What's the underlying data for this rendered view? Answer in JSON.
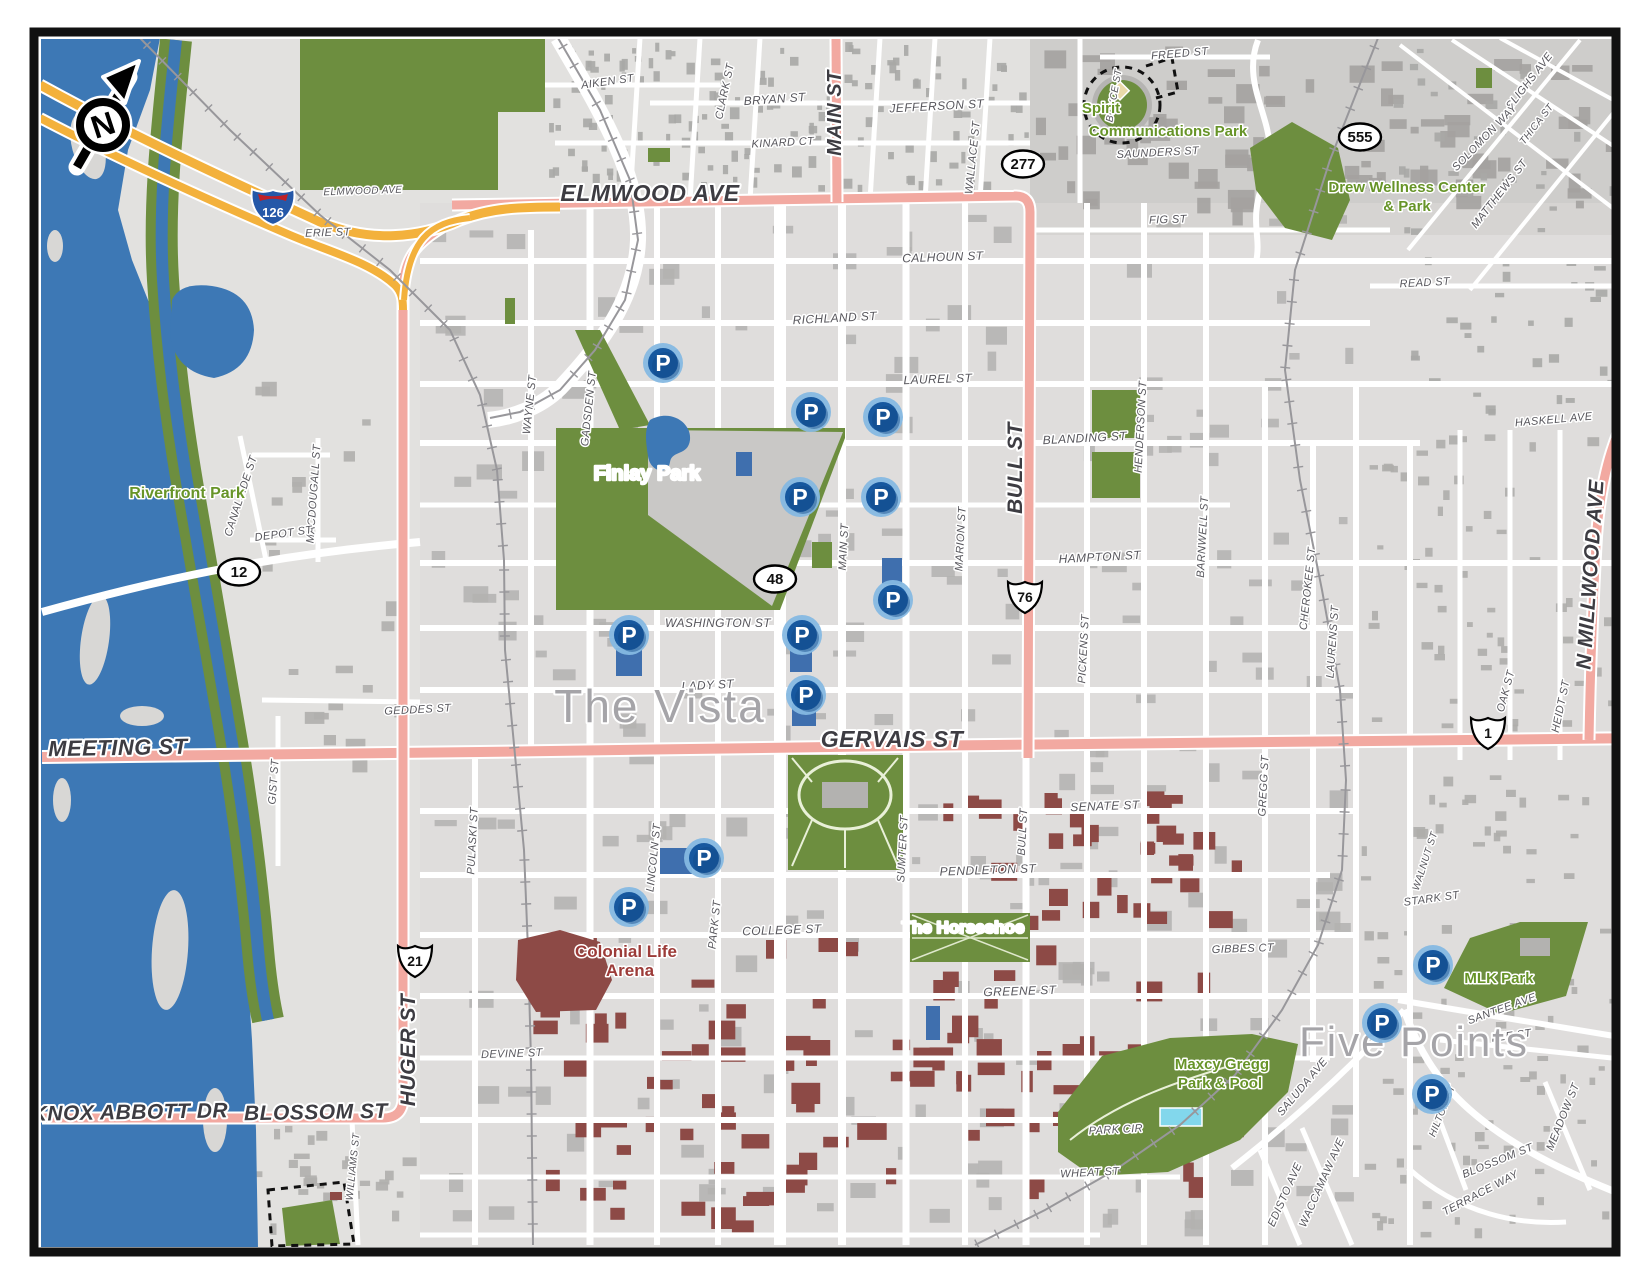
{
  "colors": {
    "land": "#e2e1df",
    "block_dark": "#cecdcb",
    "building": "#aeadab",
    "campus_building": "#8d4a46",
    "park_green": "#6d8e3f",
    "water_blue": "#3d78b5",
    "pool_cyan": "#82d7ec",
    "road_pink": "#f2a9a1",
    "freeway_yellow": "#f3b13c",
    "parking_blue": "#17589f",
    "parking_ring": "#85b8e2",
    "label_gray": "#57565c"
  },
  "compass": {
    "label": "N"
  },
  "shields": [
    {
      "type": "interstate",
      "text": "126",
      "x": 273,
      "y": 207
    },
    {
      "type": "oval",
      "text": "277",
      "x": 1023,
      "y": 164
    },
    {
      "type": "oval",
      "text": "555",
      "x": 1360,
      "y": 137
    },
    {
      "type": "oval",
      "text": "12",
      "x": 239,
      "y": 572
    },
    {
      "type": "oval",
      "text": "48",
      "x": 775,
      "y": 579
    },
    {
      "type": "us",
      "text": "76",
      "x": 1025,
      "y": 597
    },
    {
      "type": "us",
      "text": "1",
      "x": 1488,
      "y": 733
    },
    {
      "type": "us",
      "text": "21",
      "x": 415,
      "y": 961
    }
  ],
  "parking_markers": [
    {
      "x": 663,
      "y": 363
    },
    {
      "x": 811,
      "y": 412
    },
    {
      "x": 883,
      "y": 417
    },
    {
      "x": 800,
      "y": 497
    },
    {
      "x": 881,
      "y": 497
    },
    {
      "x": 893,
      "y": 600
    },
    {
      "x": 629,
      "y": 635
    },
    {
      "x": 802,
      "y": 635
    },
    {
      "x": 806,
      "y": 695
    },
    {
      "x": 704,
      "y": 858
    },
    {
      "x": 629,
      "y": 907
    },
    {
      "x": 1433,
      "y": 965
    },
    {
      "x": 1382,
      "y": 1023
    },
    {
      "x": 1432,
      "y": 1094
    }
  ],
  "labels": [
    {
      "t": "AIKEN ST",
      "x": 608,
      "y": 85,
      "r": -8,
      "c": "st",
      "s": 11
    },
    {
      "t": "CLARK ST",
      "x": 728,
      "y": 92,
      "r": -78,
      "c": "st",
      "s": 11
    },
    {
      "t": "BRYAN ST",
      "x": 775,
      "y": 103,
      "r": -4,
      "c": "st",
      "s": 12
    },
    {
      "t": "KINARD CT",
      "x": 783,
      "y": 146,
      "r": -3,
      "c": "st",
      "s": 11
    },
    {
      "t": "MAIN ST",
      "x": 841,
      "y": 113,
      "r": -90,
      "c": "maj",
      "s": 20
    },
    {
      "t": "JEFFERSON ST",
      "x": 937,
      "y": 110,
      "r": -3,
      "c": "st",
      "s": 12
    },
    {
      "t": "WALLACE ST",
      "x": 976,
      "y": 158,
      "r": -84,
      "c": "st",
      "s": 11
    },
    {
      "t": "FREED ST",
      "x": 1180,
      "y": 57,
      "r": -5,
      "c": "st",
      "s": 11
    },
    {
      "t": "BOYCE ST",
      "x": 1117,
      "y": 96,
      "r": -80,
      "c": "st",
      "s": 10
    },
    {
      "t": "SAUNDERS ST",
      "x": 1158,
      "y": 156,
      "r": -3,
      "c": "st",
      "s": 11
    },
    {
      "t": "FIG ST",
      "x": 1168,
      "y": 223,
      "r": -2,
      "c": "st",
      "s": 11
    },
    {
      "t": "SLIGHS AVE",
      "x": 1532,
      "y": 83,
      "r": -52,
      "c": "st",
      "s": 11
    },
    {
      "t": "THICA ST",
      "x": 1539,
      "y": 126,
      "r": -52,
      "c": "st",
      "s": 10
    },
    {
      "t": "SOLOMON WAY",
      "x": 1487,
      "y": 140,
      "r": -46,
      "c": "st",
      "s": 11
    },
    {
      "t": "MATTHEWS ST",
      "x": 1502,
      "y": 196,
      "r": -52,
      "c": "st",
      "s": 11
    },
    {
      "t": "READ ST",
      "x": 1425,
      "y": 286,
      "r": -3,
      "c": "st",
      "s": 11
    },
    {
      "t": "HASKELL AVE",
      "x": 1554,
      "y": 423,
      "r": -5,
      "c": "st",
      "s": 11
    },
    {
      "t": "ELMWOOD AVE",
      "x": 363,
      "y": 194,
      "r": -2,
      "c": "st",
      "s": 10
    },
    {
      "t": "ERIE ST",
      "x": 328,
      "y": 236,
      "r": -2,
      "c": "st",
      "s": 11
    },
    {
      "t": "ELMWOOD AVE",
      "x": 650,
      "y": 201,
      "r": 0,
      "c": "maj",
      "s": 23
    },
    {
      "t": "CALHOUN ST",
      "x": 943,
      "y": 261,
      "r": -2,
      "c": "st",
      "s": 12
    },
    {
      "t": "RICHLAND ST",
      "x": 835,
      "y": 322,
      "r": -3,
      "c": "st",
      "s": 12
    },
    {
      "t": "LAUREL ST",
      "x": 938,
      "y": 383,
      "r": -2,
      "c": "st",
      "s": 12
    },
    {
      "t": "BLANDING ST",
      "x": 1085,
      "y": 442,
      "r": -3,
      "c": "st",
      "s": 12
    },
    {
      "t": "HAMPTON ST",
      "x": 1100,
      "y": 561,
      "r": -3,
      "c": "st",
      "s": 12
    },
    {
      "t": "WASHINGTON ST",
      "x": 718,
      "y": 627,
      "r": 0,
      "c": "st",
      "s": 12
    },
    {
      "t": "LADY ST",
      "x": 708,
      "y": 689,
      "r": -3,
      "c": "st",
      "s": 12
    },
    {
      "t": "GERVAIS ST",
      "x": 892,
      "y": 747,
      "r": 0,
      "c": "maj",
      "s": 23
    },
    {
      "t": "SENATE ST",
      "x": 1105,
      "y": 810,
      "r": -2,
      "c": "st",
      "s": 12
    },
    {
      "t": "PENDLETON ST",
      "x": 988,
      "y": 874,
      "r": -2,
      "c": "st",
      "s": 12
    },
    {
      "t": "COLLEGE ST",
      "x": 782,
      "y": 934,
      "r": -2,
      "c": "st",
      "s": 12
    },
    {
      "t": "GREENE ST",
      "x": 1020,
      "y": 995,
      "r": -2,
      "c": "st",
      "s": 12
    },
    {
      "t": "GIBBES CT",
      "x": 1243,
      "y": 952,
      "r": -2,
      "c": "st",
      "s": 11
    },
    {
      "t": "DEVINE ST",
      "x": 512,
      "y": 1057,
      "r": -2,
      "c": "st",
      "s": 11
    },
    {
      "t": "WHEAT ST",
      "x": 1090,
      "y": 1176,
      "r": -3,
      "c": "st",
      "s": 11
    },
    {
      "t": "PARK CIR",
      "x": 1116,
      "y": 1133,
      "r": -3,
      "c": "st",
      "s": 11
    },
    {
      "t": "MEETING ST",
      "x": 118,
      "y": 755,
      "r": -1,
      "c": "maj",
      "s": 22
    },
    {
      "t": "GEDDES ST",
      "x": 418,
      "y": 713,
      "r": -3,
      "c": "st",
      "s": 11
    },
    {
      "t": "KNOX ABBOTT DR",
      "x": 130,
      "y": 1119,
      "r": -1,
      "c": "maj",
      "s": 21
    },
    {
      "t": "BLOSSOM ST",
      "x": 316,
      "y": 1119,
      "r": -1,
      "c": "maj",
      "s": 21
    },
    {
      "t": "CANALSIDE ST",
      "x": 244,
      "y": 497,
      "r": -72,
      "c": "st",
      "s": 11
    },
    {
      "t": "MACDOUGALL ST",
      "x": 317,
      "y": 494,
      "r": -86,
      "c": "st",
      "s": 11
    },
    {
      "t": "DEPOT ST",
      "x": 284,
      "y": 537,
      "r": -8,
      "c": "st",
      "s": 11
    },
    {
      "t": "GIST ST",
      "x": 277,
      "y": 782,
      "r": -86,
      "c": "st",
      "s": 11
    },
    {
      "t": "WILLIAMS ST",
      "x": 356,
      "y": 1167,
      "r": -84,
      "c": "st",
      "s": 10
    },
    {
      "t": "HUGER ST",
      "x": 415,
      "y": 1050,
      "r": -90,
      "c": "maj",
      "s": 21
    },
    {
      "t": "PULASKI ST",
      "x": 476,
      "y": 841,
      "r": -87,
      "c": "st",
      "s": 11
    },
    {
      "t": "LINCOLN ST",
      "x": 657,
      "y": 858,
      "r": -84,
      "c": "st",
      "s": 11
    },
    {
      "t": "PARK ST",
      "x": 718,
      "y": 925,
      "r": -84,
      "c": "st",
      "s": 11
    },
    {
      "t": "WAYNE ST",
      "x": 533,
      "y": 405,
      "r": -84,
      "c": "st",
      "s": 11
    },
    {
      "t": "GADSDEN ST",
      "x": 592,
      "y": 409,
      "r": -84,
      "c": "st",
      "s": 11
    },
    {
      "t": "MAIN ST",
      "x": 847,
      "y": 547,
      "r": -87,
      "c": "st",
      "s": 11
    },
    {
      "t": "MARION ST",
      "x": 964,
      "y": 539,
      "r": -87,
      "c": "st",
      "s": 11
    },
    {
      "t": "SUMTER ST",
      "x": 906,
      "y": 849,
      "r": -87,
      "c": "st",
      "s": 11
    },
    {
      "t": "BULL ST",
      "x": 1022,
      "y": 468,
      "r": -90,
      "c": "maj",
      "s": 21
    },
    {
      "t": "BULL ST",
      "x": 1026,
      "y": 832,
      "r": -87,
      "c": "st",
      "s": 11
    },
    {
      "t": "PICKENS ST",
      "x": 1087,
      "y": 649,
      "r": -87,
      "c": "st",
      "s": 11
    },
    {
      "t": "HENDERSON ST",
      "x": 1144,
      "y": 427,
      "r": -87,
      "c": "st",
      "s": 11
    },
    {
      "t": "BARNWELL ST",
      "x": 1206,
      "y": 537,
      "r": -87,
      "c": "st",
      "s": 11
    },
    {
      "t": "GREGG ST",
      "x": 1267,
      "y": 786,
      "r": -87,
      "c": "st",
      "s": 11
    },
    {
      "t": "CHEROKEE ST",
      "x": 1311,
      "y": 589,
      "r": -84,
      "c": "st",
      "s": 11
    },
    {
      "t": "LAURENS ST",
      "x": 1336,
      "y": 642,
      "r": -86,
      "c": "st",
      "s": 11
    },
    {
      "t": "OAK ST",
      "x": 1509,
      "y": 692,
      "r": -75,
      "c": "st",
      "s": 11
    },
    {
      "t": "HEIDT ST",
      "x": 1564,
      "y": 707,
      "r": -78,
      "c": "st",
      "s": 11
    },
    {
      "t": "N MILLWOOD AVE",
      "x": 1597,
      "y": 575,
      "r": -86,
      "c": "maj",
      "s": 21
    },
    {
      "t": "STARK ST",
      "x": 1432,
      "y": 902,
      "r": -8,
      "c": "st",
      "s": 11
    },
    {
      "t": "WALNUT ST",
      "x": 1428,
      "y": 862,
      "r": -72,
      "c": "st",
      "s": 10
    },
    {
      "t": "SANTEE AVE",
      "x": 1503,
      "y": 1012,
      "r": -20,
      "c": "st",
      "s": 11
    },
    {
      "t": "LEE ST",
      "x": 1512,
      "y": 1039,
      "r": -8,
      "c": "st",
      "s": 11
    },
    {
      "t": "SALUDA AVE",
      "x": 1305,
      "y": 1089,
      "r": -50,
      "c": "st",
      "s": 11
    },
    {
      "t": "HILTON ST",
      "x": 1445,
      "y": 1112,
      "r": -68,
      "c": "st",
      "s": 10
    },
    {
      "t": "MEADOW ST",
      "x": 1566,
      "y": 1118,
      "r": -68,
      "c": "st",
      "s": 11
    },
    {
      "t": "BLOSSOM ST",
      "x": 1499,
      "y": 1164,
      "r": -22,
      "c": "st",
      "s": 11
    },
    {
      "t": "TERRACE WAY",
      "x": 1482,
      "y": 1196,
      "r": -28,
      "c": "st",
      "s": 11
    },
    {
      "t": "WACCAMAW AVE",
      "x": 1325,
      "y": 1184,
      "r": -66,
      "c": "st",
      "s": 11
    },
    {
      "t": "EDISTO AVE",
      "x": 1288,
      "y": 1196,
      "r": -66,
      "c": "st",
      "s": 11
    },
    {
      "t": "The Vista",
      "x": 660,
      "y": 722,
      "r": 0,
      "c": "area",
      "s": 46
    },
    {
      "t": "Five Points",
      "x": 1414,
      "y": 1056,
      "r": 0,
      "c": "area",
      "s": 42
    },
    {
      "t": "Riverfront Park",
      "x": 187,
      "y": 498,
      "r": 0,
      "c": "park",
      "s": 16
    },
    {
      "t": "Finlay Park",
      "x": 647,
      "y": 480,
      "r": 0,
      "c": "pw",
      "s": 20
    },
    {
      "t": "Spirit",
      "x": 1101,
      "y": 113,
      "r": 0,
      "c": "park",
      "s": 15
    },
    {
      "t": "Communications Park",
      "x": 1168,
      "y": 136,
      "r": 0,
      "c": "park",
      "s": 15
    },
    {
      "t": "Drew Wellness Center",
      "x": 1407,
      "y": 192,
      "r": 0,
      "c": "park",
      "s": 15
    },
    {
      "t": "& Park",
      "x": 1407,
      "y": 211,
      "r": 0,
      "c": "park",
      "s": 15
    },
    {
      "t": "MLK Park",
      "x": 1499,
      "y": 983,
      "r": 0,
      "c": "park",
      "s": 15
    },
    {
      "t": "Maxcy Gregg",
      "x": 1222,
      "y": 1069,
      "r": 0,
      "c": "park",
      "s": 15
    },
    {
      "t": "Park & Pool",
      "x": 1220,
      "y": 1088,
      "r": 0,
      "c": "park",
      "s": 15
    },
    {
      "t": "The Horseshoe",
      "x": 963,
      "y": 933,
      "r": 0,
      "c": "pw",
      "s": 17
    },
    {
      "t": "Colonial Life",
      "x": 626,
      "y": 957,
      "r": 0,
      "c": "mar",
      "s": 17
    },
    {
      "t": "Arena",
      "x": 630,
      "y": 976,
      "r": 0,
      "c": "mar",
      "s": 17
    }
  ]
}
